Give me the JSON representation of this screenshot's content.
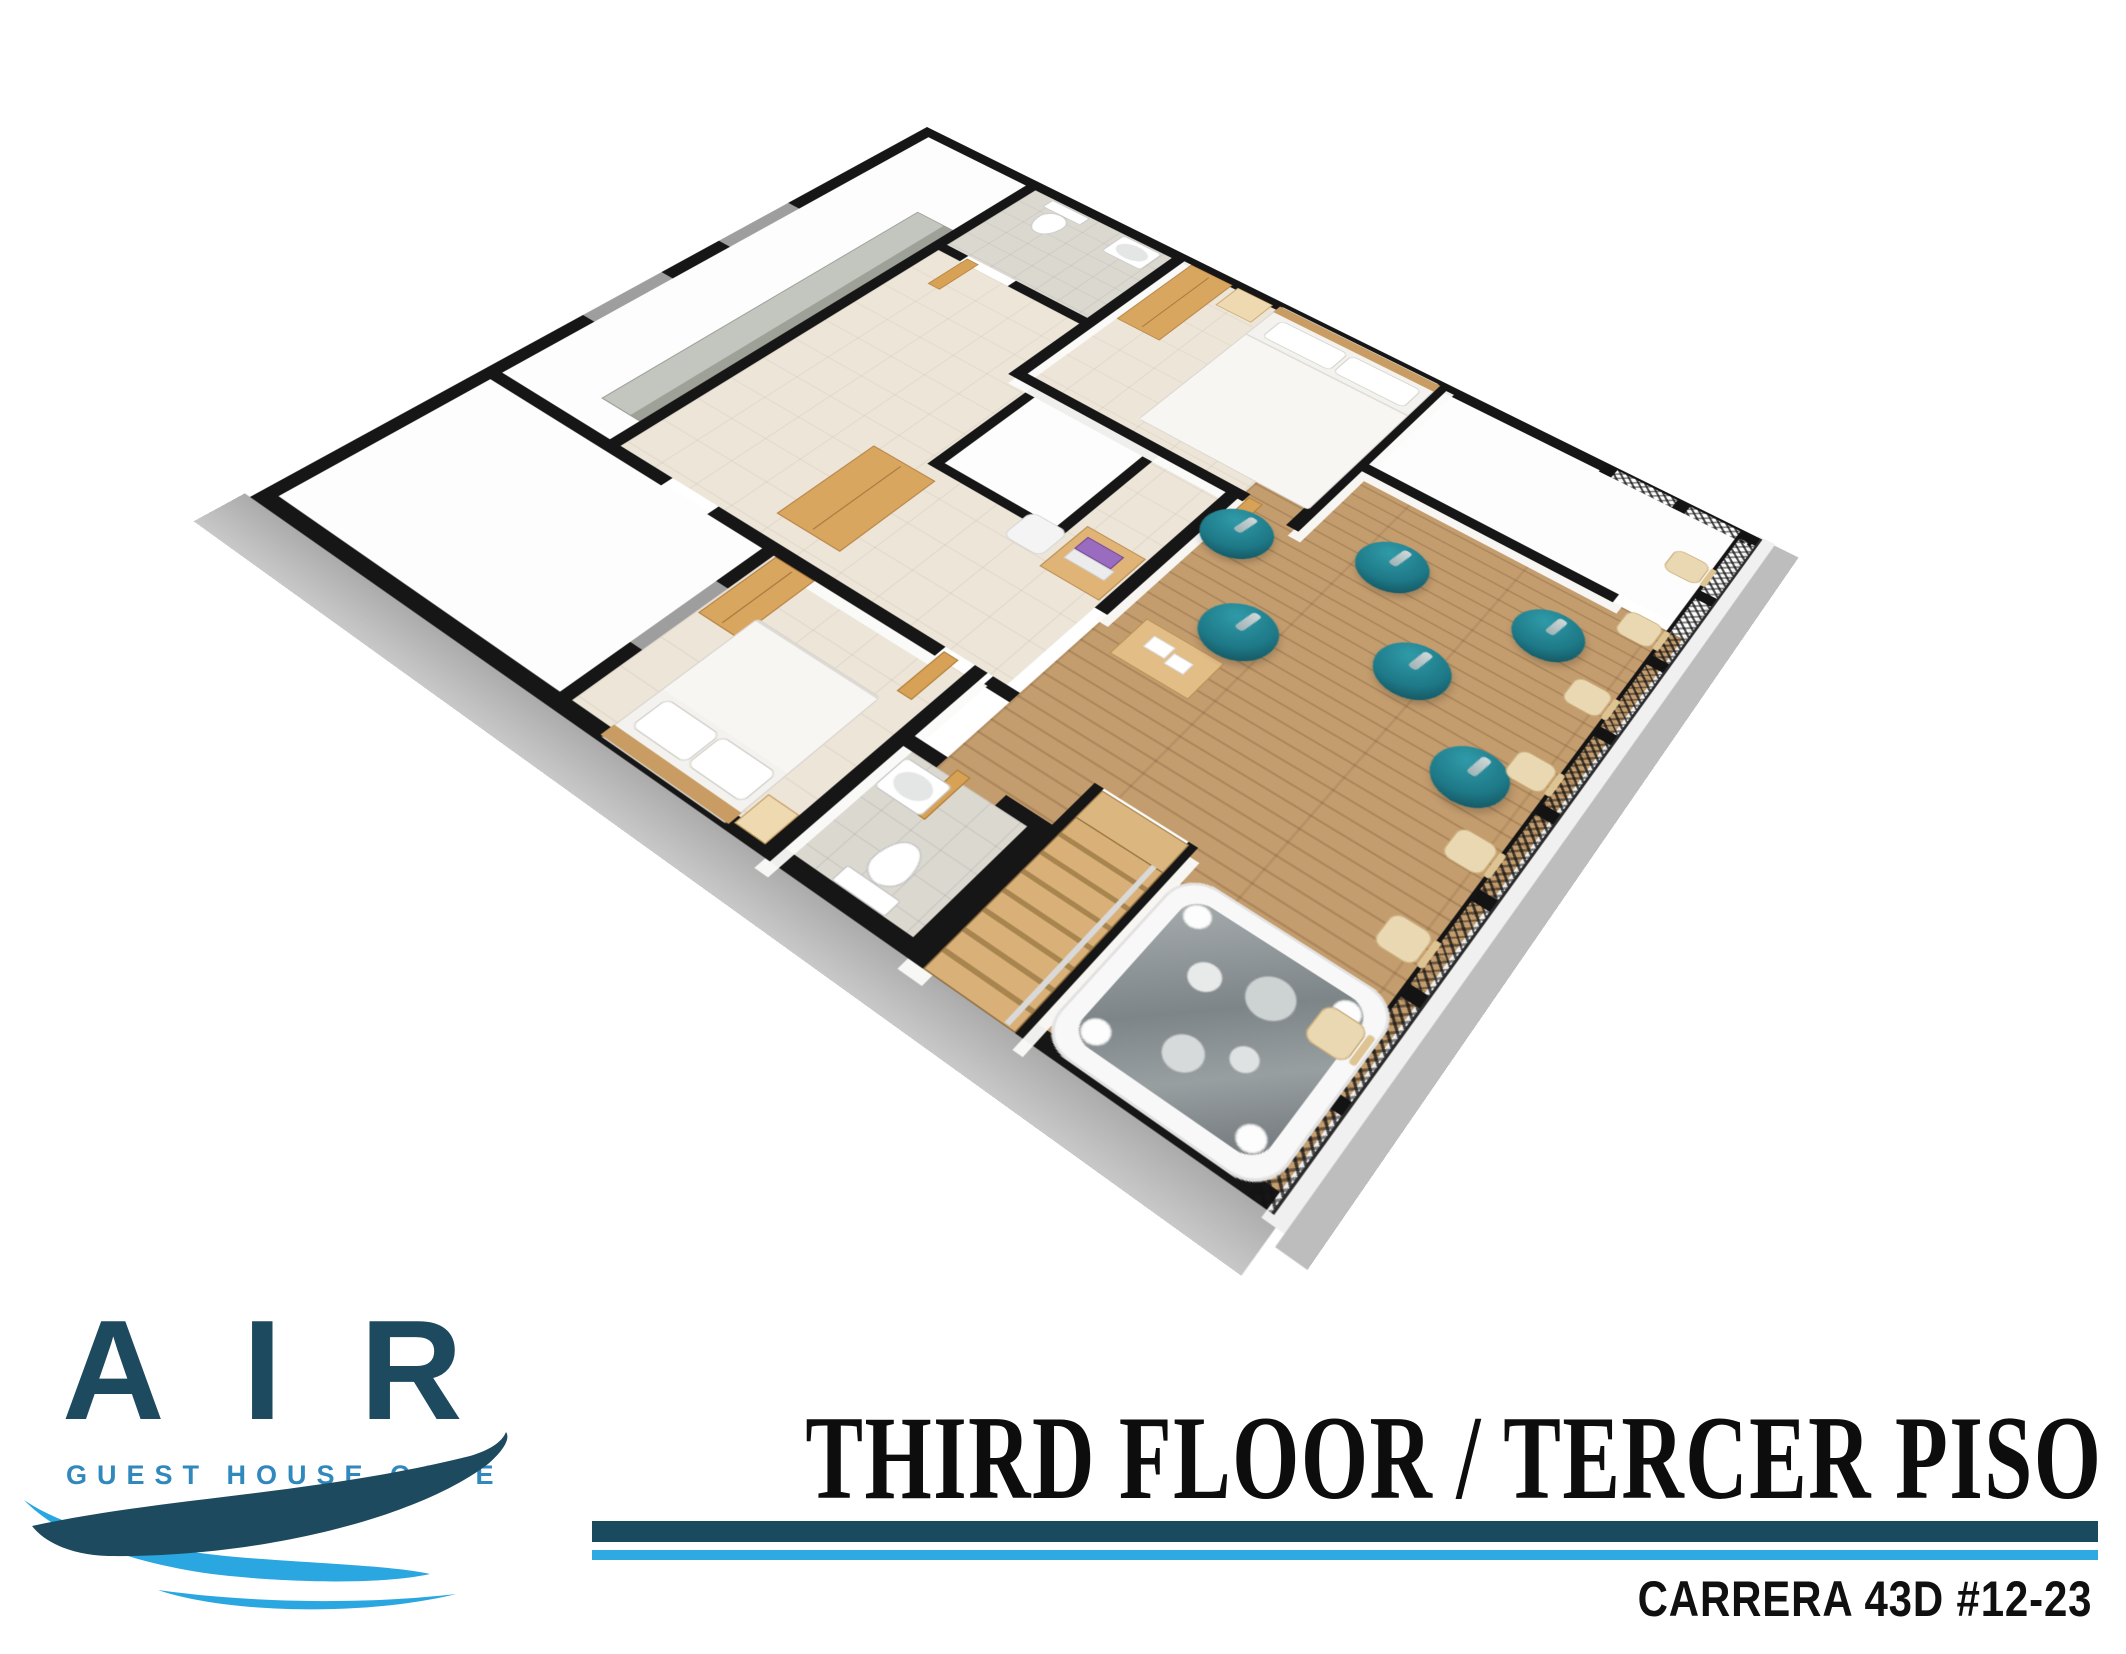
{
  "branding": {
    "logo_text": "AIR",
    "logo_tagline": "GUEST HOUSE CAFE"
  },
  "title_block": {
    "title": "THIRD FLOOR / TERCER PISO",
    "address": "CARRERA 43D #12-23"
  },
  "colors": {
    "logo_dark_teal": "#1d4a5f",
    "logo_tagline_blue": "#3088bd",
    "wave_dark": "#1d4a5f",
    "wave_light": "#2aa7e0",
    "rule_dark": "#1a4a5d",
    "rule_light": "#2fa9e1",
    "wall_black": "#161616",
    "deck_wood": "#c49d6e",
    "bean_bag_teal": "#1e7987",
    "base_gray": "#b5b5b5"
  },
  "floorplan": {
    "view": "3d-isometric-floor-plan",
    "rooms": [
      {
        "id": "long-room",
        "features": [
          "gray-counter",
          "windows"
        ]
      },
      {
        "id": "bathroom-top",
        "features": [
          "toilet",
          "sink"
        ]
      },
      {
        "id": "bedroom-top",
        "features": [
          "double-bed",
          "wardrobe",
          "nightstand"
        ]
      },
      {
        "id": "hallway",
        "features": [
          "wardrobe",
          "desk",
          "laptop",
          "chair"
        ]
      },
      {
        "id": "void-top",
        "features": []
      },
      {
        "id": "void-middle",
        "features": []
      },
      {
        "id": "storage-room",
        "features": []
      },
      {
        "id": "bedroom-left",
        "features": [
          "double-bed",
          "wardrobe",
          "nightstand",
          "window"
        ]
      },
      {
        "id": "bathroom-bottom",
        "features": [
          "toilet",
          "sink"
        ]
      },
      {
        "id": "stairwell",
        "features": [
          "stairs",
          "handrail"
        ]
      },
      {
        "id": "terrace",
        "features": [
          "wood-deck",
          "bean-bags",
          "bar-stools",
          "coffee-table",
          "hot-tub",
          "mesh-railing"
        ]
      }
    ],
    "bean_bags": [
      [
        583,
        298,
        30
      ],
      [
        646,
        390,
        31
      ],
      [
        700,
        246,
        30
      ],
      [
        770,
        336,
        30
      ],
      [
        834,
        230,
        29
      ],
      [
        855,
        400,
        29
      ]
    ],
    "bar_stools": [
      [
        872,
        62
      ],
      [
        872,
        158
      ],
      [
        872,
        254
      ],
      [
        872,
        350
      ],
      [
        872,
        444
      ],
      [
        872,
        538
      ],
      [
        874,
        628
      ]
    ],
    "counts": {
      "bedrooms": 2,
      "bathrooms": 2,
      "bean_bags": 6,
      "bar_stools": 7,
      "hot_tubs": 1
    }
  }
}
